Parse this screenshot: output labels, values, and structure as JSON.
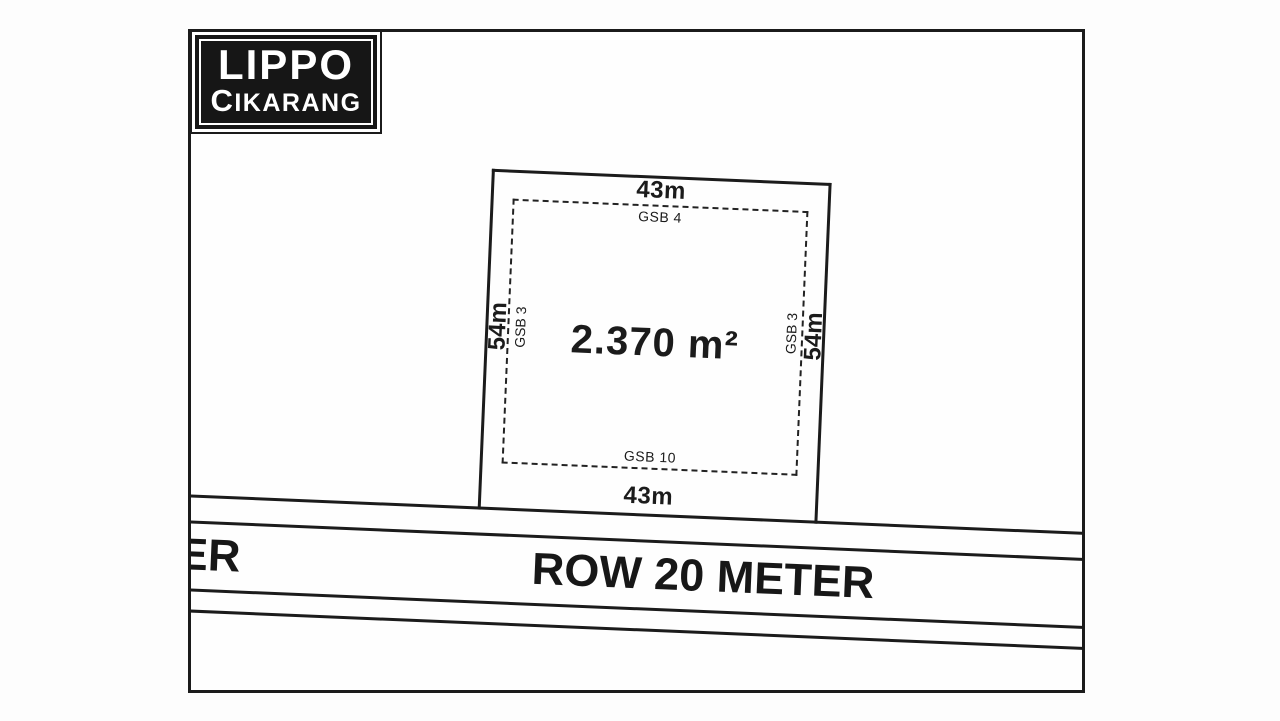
{
  "colors": {
    "ink": "#1b1b1b",
    "paper": "#fdfdfd",
    "logo_bg": "#161616",
    "logo_text": "#ffffff"
  },
  "logo": {
    "line1": "LIPPO",
    "line2": "CIKARANG"
  },
  "plot": {
    "area": "2.370 m²",
    "top_width": "43m",
    "bottom_width": "43m",
    "left_depth": "54m",
    "right_depth": "54m",
    "setback_top": "GSB 4",
    "setback_left": "GSB 3",
    "setback_right": "GSB 3",
    "setback_bottom": "GSB 10"
  },
  "road": {
    "name": "ROW 20 METER",
    "clipped_label_left": "ER"
  }
}
